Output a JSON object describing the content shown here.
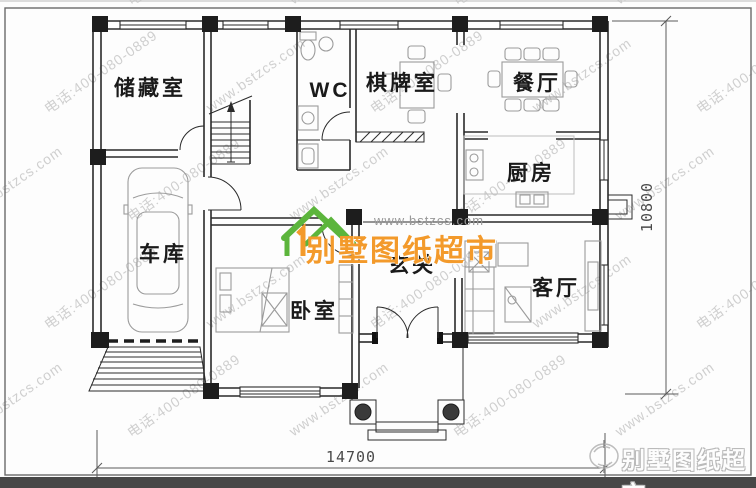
{
  "watermark": {
    "url": "www.bstzcs.com",
    "phone": "电话:400-080-0889"
  },
  "logo": {
    "site": "www.bstzcs.com",
    "name": "别墅图纸超市"
  },
  "corner_logo": {
    "name": "别墅图纸超市"
  },
  "rooms": {
    "storage": "储藏室",
    "wc": "WC",
    "chess": "棋牌室",
    "dining": "餐厅",
    "kitchen": "厨房",
    "garage": "车库",
    "bedroom": "卧室",
    "foyer": "玄关",
    "living": "客厅"
  },
  "dimensions": {
    "width": "14700",
    "height": "10800"
  },
  "colors": {
    "logo_green": "#5cb53c",
    "logo_orange": "#f39a2b",
    "watermark_gray": "#c7c7c7"
  }
}
